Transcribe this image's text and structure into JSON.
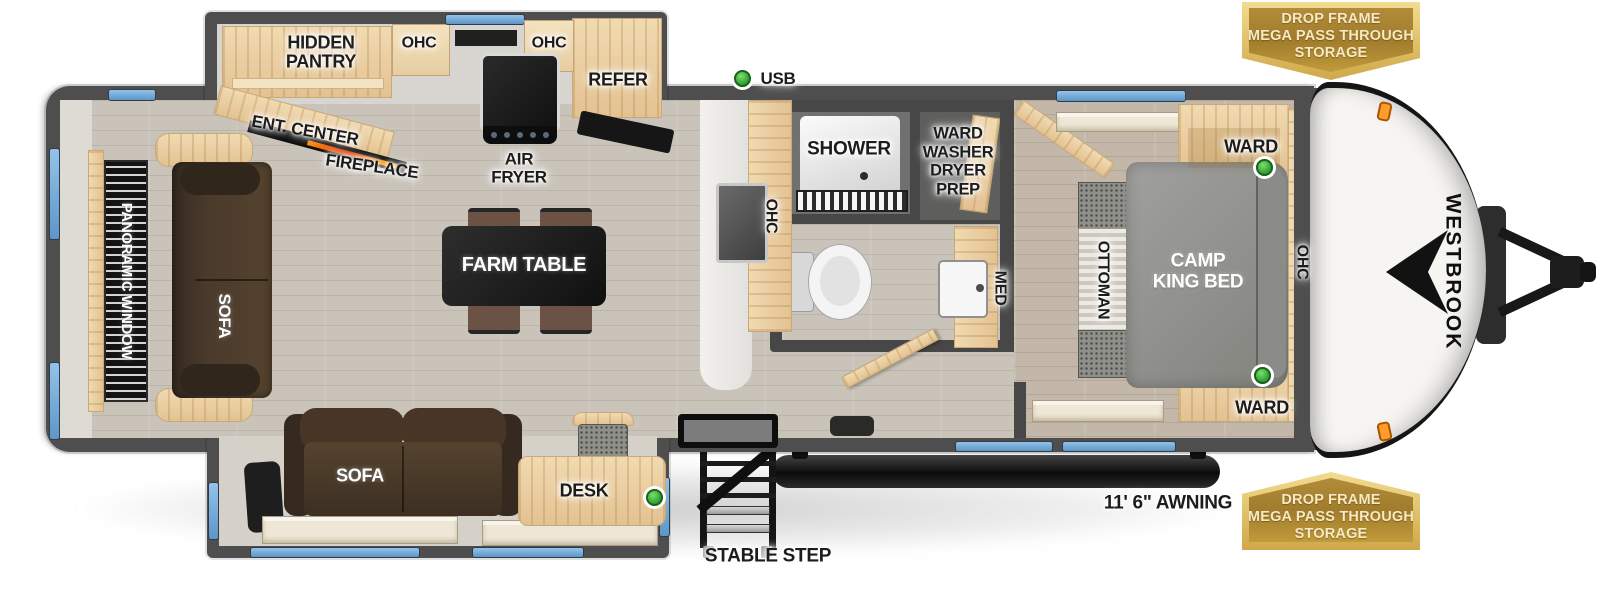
{
  "trailer": {
    "brand": "WESTBROOK"
  },
  "callouts": {
    "usb": "USB",
    "awning": "11' 6\" AWNING",
    "stable_step": "STABLE STEP",
    "storage_badge": "DROP FRAME\nMEGA PASS THROUGH\nSTORAGE"
  },
  "kitchen": {
    "hidden_pantry": "HIDDEN\nPANTRY",
    "ohc_left": "OHC",
    "ohc_right": "OHC",
    "refer": "REFER",
    "air_fryer": "AIR\nFRYER",
    "ent_center": "ENT. CENTER",
    "fireplace": "FIREPLACE",
    "farm_table": "FARM TABLE",
    "island_ohc": "OHC"
  },
  "living": {
    "panoramic_window": "PANORAMIC WINDOW",
    "rear_sofa": "SOFA",
    "slide_sofa": "SOFA",
    "desk": "DESK"
  },
  "bathroom": {
    "shower": "SHOWER",
    "ward_washer_dryer_prep": "WARD\nWASHER\nDRYER\nPREP",
    "med": "MED"
  },
  "bedroom": {
    "ward_top": "WARD",
    "ward_bottom": "WARD",
    "bed": "CAMP\nKING BED",
    "ottoman": "OTTOMAN",
    "ohc": "OHC"
  },
  "colors": {
    "wall_gray": "#4e4e4e",
    "window_blue": "#74a9d8",
    "usb_green": "#3eb53e",
    "badge_gold": "#c19a3b",
    "awning_black": "#111111",
    "wood": "#e9cfa6",
    "bed_gray": "#8f8f8c"
  }
}
